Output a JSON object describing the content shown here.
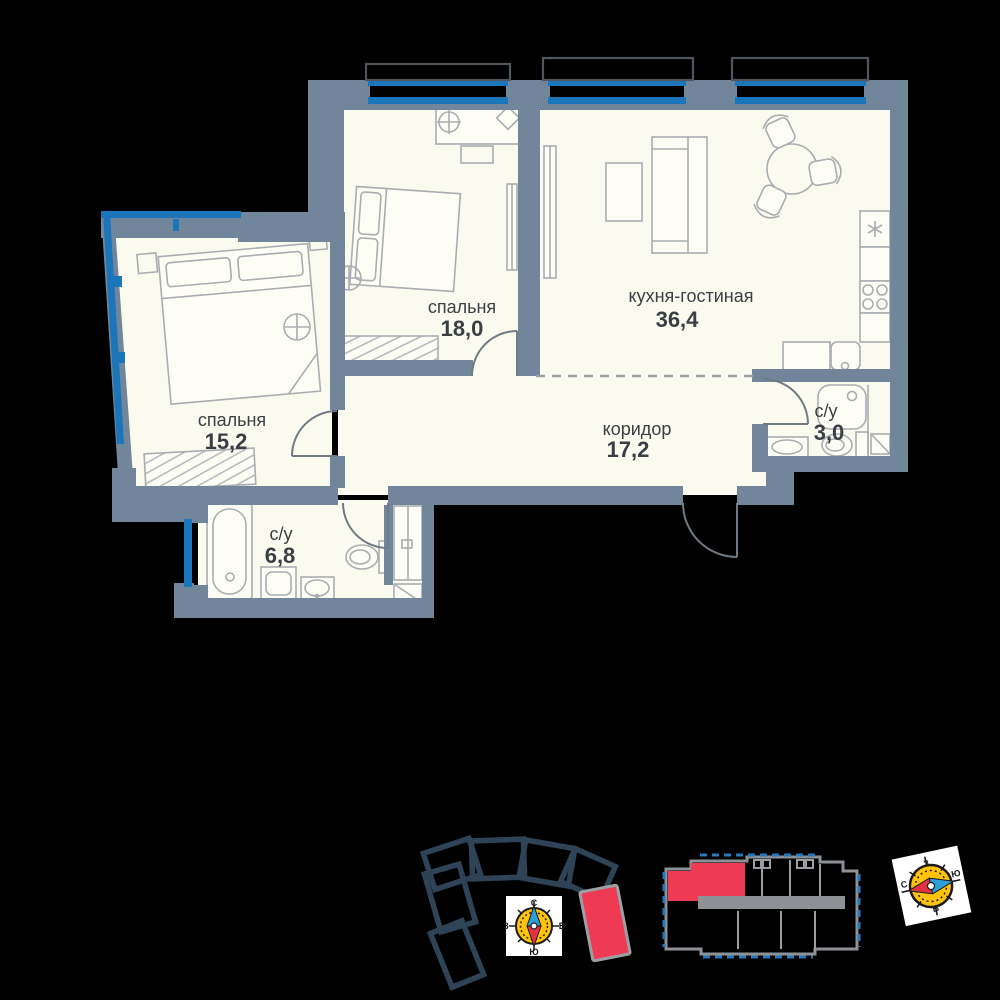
{
  "title": "apartment-floor-plan",
  "colors": {
    "background": "#000000",
    "wall": "#71869A",
    "floor": "#FBFAEE",
    "window": "#1B75BB",
    "furniture_line": "#A9ADB2",
    "text": "#3A3F45",
    "highlight": "#EE3A52",
    "compass_dial": "#FFC40A",
    "needle_red": "#E23440",
    "needle_blue": "#2C9FD8",
    "site_outline": "#2E4456"
  },
  "rooms": [
    {
      "id": "bedroom-18",
      "name": "спальня",
      "area": "18,0"
    },
    {
      "id": "kitchen-living",
      "name": "кухня-гостиная",
      "area": "36,4"
    },
    {
      "id": "bedroom-15",
      "name": "спальня",
      "area": "15,2"
    },
    {
      "id": "corridor",
      "name": "коридор",
      "area": "17,2"
    },
    {
      "id": "bathroom-3",
      "name": "с/у",
      "area": "3,0"
    },
    {
      "id": "bathroom-6",
      "name": "с/у",
      "area": "6,8"
    }
  ],
  "compass": {
    "north": "С",
    "south": "Ю",
    "west": "З",
    "east": "В"
  }
}
